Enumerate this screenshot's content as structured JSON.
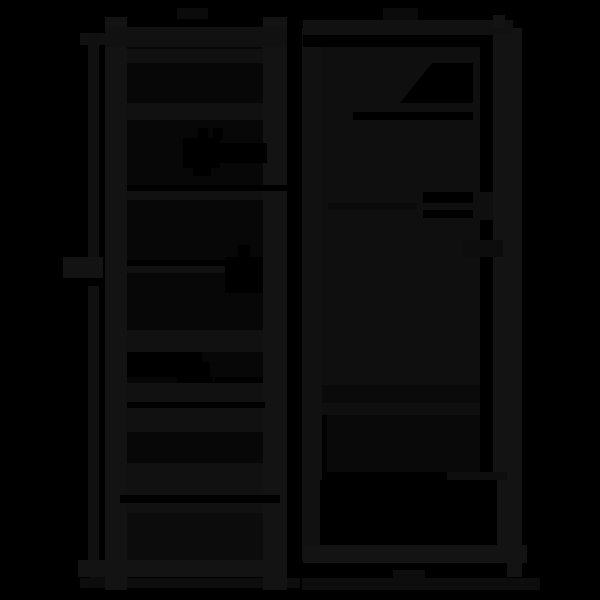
{
  "meta": {
    "description": "Near-black silhouette line drawing of two tall furniture units on a black background: left, an open ladder-style shelving rack with a vertical height dimension line beside it; right, a closed wardrobe cabinet with a door gap, two handle slots and a bottom drawer. Both stand on faint floor lines.",
    "visible_text": "none"
  },
  "palette": {
    "bg": "#000000",
    "fill": "#131313",
    "band": "#111111",
    "door": "#0f0f0f",
    "opening": "#070707",
    "panel": "#0c0c0c",
    "floor": "#0d0d0d",
    "tick": "#101010",
    "tab": "#0b0b0b",
    "seam": "#0a0a0a",
    "underdoor": "#090909",
    "bridge": "#0e0e0e",
    "notch": "#0d0d0d",
    "cut": "#000000"
  },
  "components": {
    "left_unit": "open-shelving-rack",
    "right_unit": "wardrobe-cabinet",
    "dimension_line": "height-dimension-line",
    "icons": [
      "push-arrow-icon",
      "cam-lock-icon",
      "shelf-insert-icon"
    ]
  }
}
